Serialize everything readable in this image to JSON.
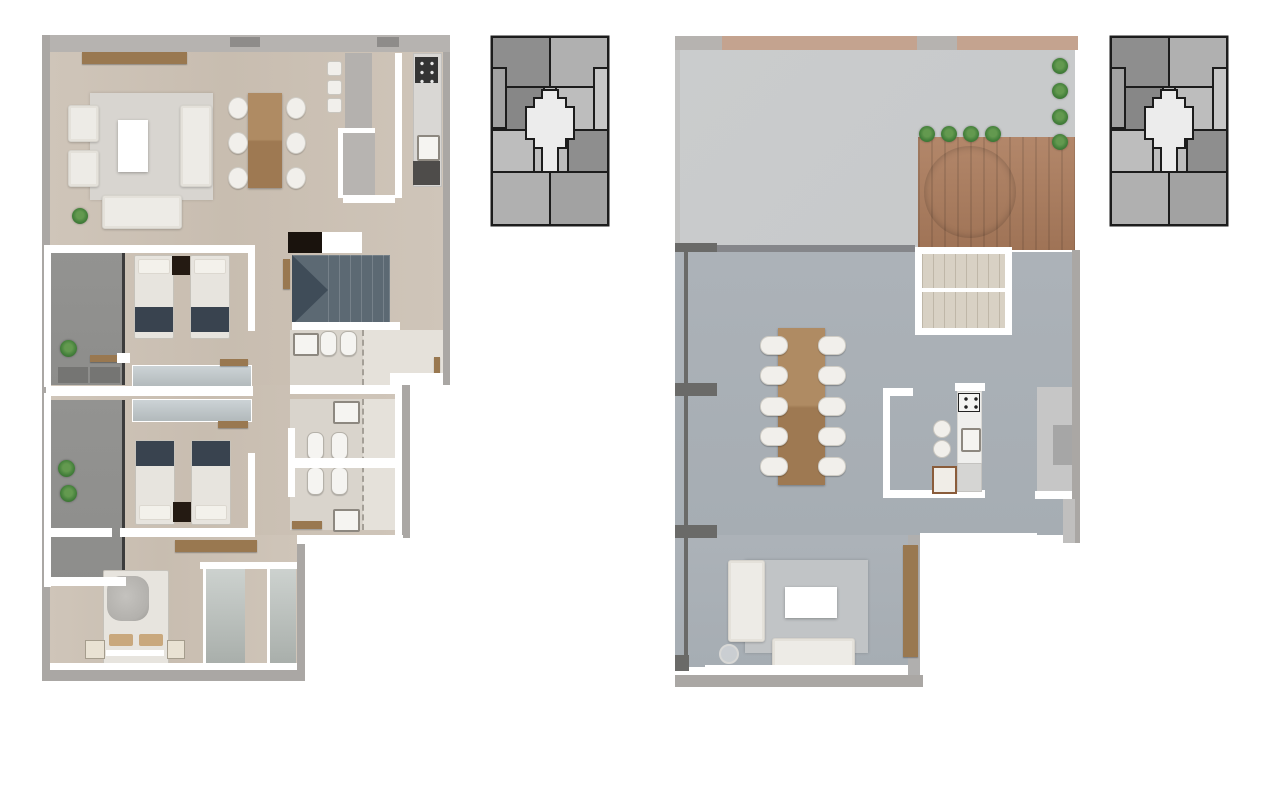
{
  "page": {
    "background": "#ffffff",
    "content": "two-level apartment floor plans with building key plans"
  },
  "colors": {
    "page_bg": "#ffffff",
    "wall_white": "#ffffff",
    "outer_gray": "#aaa7a4",
    "top_band": "#b6b3b0",
    "band_dark": "#8e8c8a",
    "wood_floor": "#cfc5b9",
    "wood_floor_2": "#c8bdb0",
    "balcony": "#8d8d8b",
    "planter": "#757573",
    "rug_left": "#d8d5d0",
    "sofa_white": "#edebe6",
    "table_wood": "#af8b63",
    "table_wood_dark": "#9e7952",
    "chair_white": "#f1efeb",
    "mattress": "#e7e4de",
    "pillow_white": "#f3f1eb",
    "bed_navy": "#39434f",
    "nightstand_dark": "#241a12",
    "pillow_tan": "#c9a87d",
    "throw_gray": "#b3b1ad",
    "mirror_hi": "#ccd3d6",
    "mirror_lo": "#b2b9bb",
    "closet_hi": "#cdd2cf",
    "closet_lo": "#a9afab",
    "stair_slate": "#5c6973",
    "stair_slate_dark": "#3f4c58",
    "bath_floor": "#d9d4cc",
    "shower_floor": "#e5e1da",
    "fixture": "#f5f4f1",
    "fixture_line": "#8d8880",
    "glass": "#a49f97",
    "plant": "#44803b",
    "plant_dark": "#2e5e2a",
    "console_wood": "#997850",
    "black_box": "#1a130d",
    "counter_gray": "#d9d7d4",
    "counter_dark": "#4e4c4a",
    "stove_dark": "#343434",
    "terrace": "#c7c9ca",
    "terrace_wall": "#c2c2c1",
    "interior": "#acb2b8",
    "interior_2": "#a6adb3",
    "rug_right": "#c1c4c6",
    "deck": "#b3876a",
    "deck_dark": "#9f7356",
    "tub": "#7e8c96",
    "tub_dark": "#6e7c87",
    "tan_band": "#c4a38f",
    "travertine": "#d8d1c4",
    "travertine_line": "#bfb7a8",
    "column": "#6a6a68",
    "divider": "#85868a",
    "counter_white": "#efefed",
    "cabinet": "#c6c6c6",
    "cabinet_panel": "#a6a6a6",
    "key_dark": "#8e8e8e",
    "key_dark2": "#878787",
    "key_med": "#a2a2a2",
    "key_med2": "#b0b0b0",
    "key_light": "#bdbdbd",
    "key_light2": "#c7c7c7",
    "key_hi": "#ececec",
    "key_line": "#1c1c1c"
  },
  "plans": {
    "left": {
      "name": "lower-level-floor-plan",
      "rooms": [
        "living-room",
        "dining-area",
        "kitchen",
        "hallway",
        "stairs",
        "bedroom-1",
        "bedroom-2",
        "master-bedroom",
        "dressing-corridor",
        "bathroom-1",
        "bathroom-2",
        "bathroom-3",
        "balcony-1",
        "balcony-2",
        "wardrobes"
      ],
      "counts": {
        "dining_chairs_per_side": 3,
        "bar_stools": 3,
        "twin_beds": 4,
        "double_beds": 1,
        "armchairs": 2,
        "sofas": 2,
        "balcony_plants": 3,
        "living_plants": 1
      }
    },
    "right": {
      "name": "upper-level-floor-plan",
      "rooms": [
        "roof-terrace",
        "hot-tub-deck",
        "stairs",
        "open-plan-living-dining",
        "kitchen",
        "pantry-cabinet"
      ],
      "counts": {
        "dining_chairs_per_side": 5,
        "bar_stools": 2,
        "deck_plants_top": 4,
        "deck_plants_right": 4,
        "sofas": 2
      }
    }
  },
  "key_plans": {
    "left": {
      "name": "building-key-plan",
      "highlighted_unit": "center-cross-unit"
    },
    "right": {
      "name": "building-key-plan",
      "highlighted_unit": "center-cross-unit"
    }
  }
}
